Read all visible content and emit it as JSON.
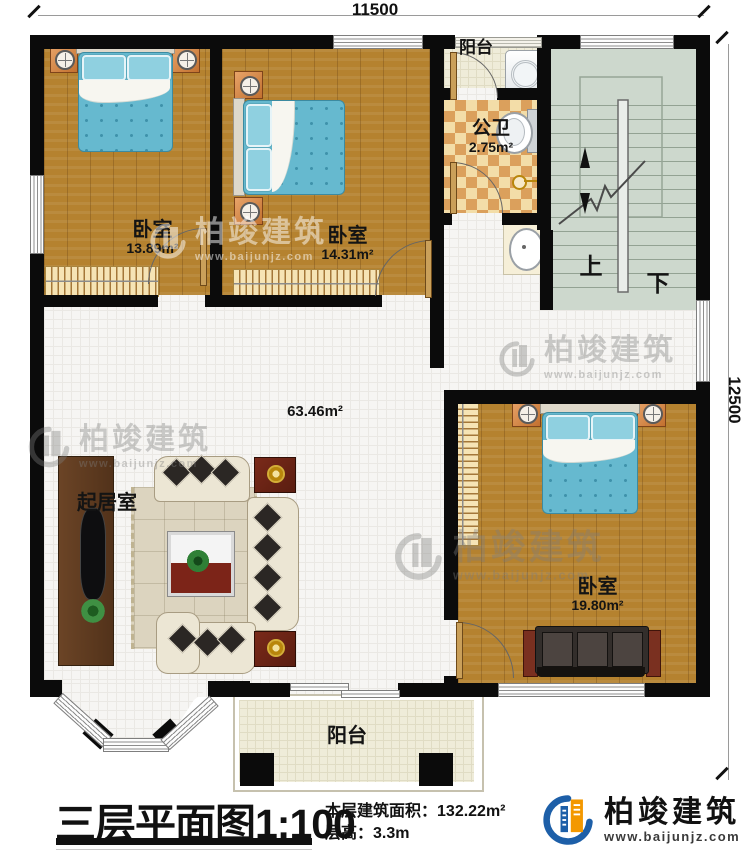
{
  "dimensions": {
    "top": "11500",
    "right": "12500"
  },
  "rooms": {
    "bedroom1": {
      "name": "卧室",
      "area": "13.89m²"
    },
    "bedroom2": {
      "name": "卧室",
      "area": "14.31m²"
    },
    "bedroom3": {
      "name": "卧室",
      "area": "19.80m²"
    },
    "living": {
      "name": "起居室",
      "area": "63.46m²"
    },
    "bathroom": {
      "name": "公卫",
      "area": "2.75m²"
    },
    "balcony_top": {
      "name": "阳台"
    },
    "balcony_bottom": {
      "name": "阳台"
    }
  },
  "stairs": {
    "up": "上",
    "down": "下"
  },
  "footer": {
    "title": "三层平面图",
    "scale": "1:100",
    "floor_area_label": "本层建筑面积：",
    "floor_area_value": "132.22m²",
    "floor_height_label": "层高：",
    "floor_height_value": "3.3m"
  },
  "brand": {
    "name": "柏竣建筑",
    "url": "www.baijunjz.com"
  },
  "watermark": {
    "name": "柏竣建筑",
    "url": "www.baijunjz.com"
  },
  "colors": {
    "wall": "#0b0b0b",
    "wood_floor": "#b5822f",
    "bed_quilt": "#66b9cf",
    "bath_tile": "#dba05c",
    "brand_blue": "#1d5fa8",
    "brand_orange": "#f39800"
  }
}
